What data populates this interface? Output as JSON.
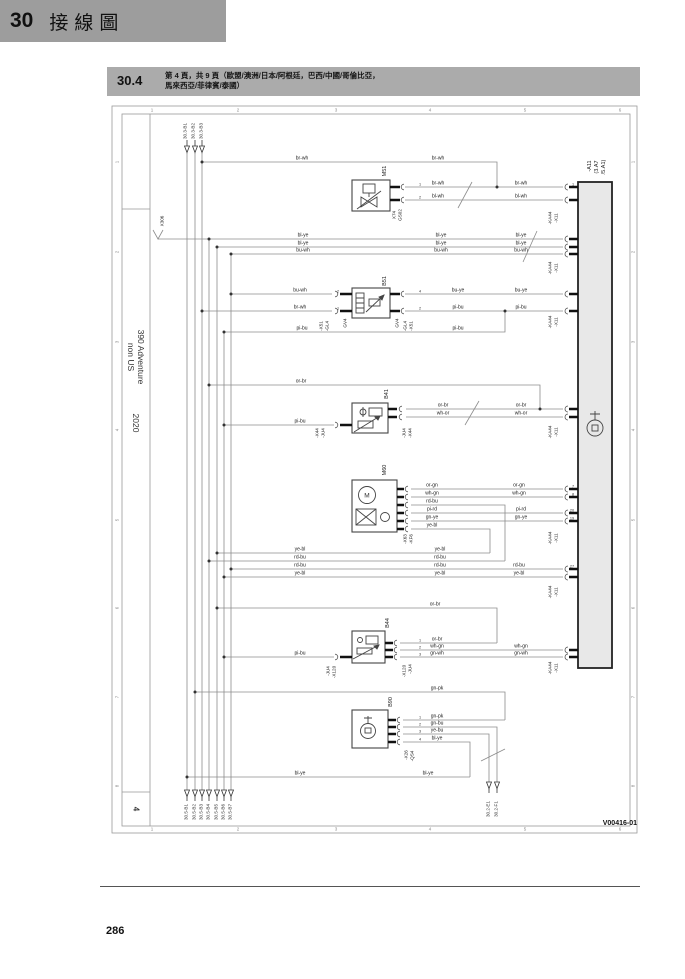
{
  "chapter": {
    "number": "30",
    "title": "接線圖"
  },
  "section": {
    "number": "30.4",
    "title_line1": "第 4 頁，共 9 頁（歐盟/澳洲/日本/阿根廷，巴西/中國/哥倫比亞，",
    "title_line2": "馬來西亞/菲律賓/泰國）"
  },
  "sidebar": {
    "model_line1": "390 Adventure",
    "model_line2": "non US",
    "year": "2020",
    "sheet": "4"
  },
  "footer": {
    "page_number": "286",
    "figure_id": "V00416-01"
  },
  "diagram": {
    "ecu_label": "-A11 (3.A7 /5.A1)",
    "ground_label": "X306",
    "component_ids": [
      "M51",
      "B51",
      "B41",
      "M60",
      "B44",
      "B90"
    ],
    "overlay_labels": [
      {
        "t": "br-wh",
        "c": "w",
        "x": 302,
        "y": 162
      },
      {
        "t": "br-wh",
        "c": "w",
        "x": 438,
        "y": 162
      },
      {
        "t": "br-wh",
        "c": "w",
        "x": 438,
        "y": 187
      },
      {
        "t": "bl-wh",
        "c": "w",
        "x": 438,
        "y": 200
      },
      {
        "t": "br-wh",
        "c": "w",
        "x": 521,
        "y": 187
      },
      {
        "t": "bl-wh",
        "c": "w",
        "x": 521,
        "y": 200
      },
      {
        "t": "bl-ye",
        "c": "w",
        "x": 303,
        "y": 239
      },
      {
        "t": "bl-ye",
        "c": "w",
        "x": 303,
        "y": 247
      },
      {
        "t": "bu-wh",
        "c": "w",
        "x": 303,
        "y": 254
      },
      {
        "t": "bl-ye",
        "c": "w",
        "x": 441,
        "y": 239
      },
      {
        "t": "bl-ye",
        "c": "w",
        "x": 441,
        "y": 247
      },
      {
        "t": "bu-wh",
        "c": "w",
        "x": 441,
        "y": 254
      },
      {
        "t": "bl-ye",
        "c": "w",
        "x": 521,
        "y": 239
      },
      {
        "t": "bl-ye",
        "c": "w",
        "x": 521,
        "y": 247
      },
      {
        "t": "bu-wh",
        "c": "w",
        "x": 521,
        "y": 254
      },
      {
        "t": "bu-wh",
        "c": "w",
        "x": 300,
        "y": 294
      },
      {
        "t": "br-wh",
        "c": "w",
        "x": 300,
        "y": 311
      },
      {
        "t": "pi-bu",
        "c": "w",
        "x": 302,
        "y": 332
      },
      {
        "t": "bu-ye",
        "c": "w",
        "x": 458,
        "y": 294
      },
      {
        "t": "pi-bu",
        "c": "w",
        "x": 458,
        "y": 311
      },
      {
        "t": "pi-bu",
        "c": "w",
        "x": 458,
        "y": 332
      },
      {
        "t": "bu-ye",
        "c": "w",
        "x": 521,
        "y": 294
      },
      {
        "t": "pi-bu",
        "c": "w",
        "x": 521,
        "y": 311
      },
      {
        "t": "or-br",
        "c": "w",
        "x": 301,
        "y": 385
      },
      {
        "t": "pi-bu",
        "c": "w",
        "x": 300,
        "y": 425
      },
      {
        "t": "or-br",
        "c": "w",
        "x": 443,
        "y": 409
      },
      {
        "t": "wh-or",
        "c": "w",
        "x": 443,
        "y": 417
      },
      {
        "t": "or-br",
        "c": "w",
        "x": 521,
        "y": 409
      },
      {
        "t": "wh-or",
        "c": "w",
        "x": 521,
        "y": 417
      },
      {
        "t": "or-gn",
        "c": "w",
        "x": 432,
        "y": 489
      },
      {
        "t": "wh-gn",
        "c": "w",
        "x": 432,
        "y": 497
      },
      {
        "t": "rd-bu",
        "c": "w",
        "x": 432,
        "y": 505
      },
      {
        "t": "pi-rd",
        "c": "w",
        "x": 432,
        "y": 513
      },
      {
        "t": "gn-ye",
        "c": "w",
        "x": 432,
        "y": 521
      },
      {
        "t": "ye-bl",
        "c": "w",
        "x": 432,
        "y": 529
      },
      {
        "t": "or-gn",
        "c": "w",
        "x": 519,
        "y": 489
      },
      {
        "t": "wh-gn",
        "c": "w",
        "x": 519,
        "y": 497
      },
      {
        "t": "pi-rd",
        "c": "w",
        "x": 521,
        "y": 513
      },
      {
        "t": "gn-ye",
        "c": "w",
        "x": 521,
        "y": 521
      },
      {
        "t": "ye-bl",
        "c": "w",
        "x": 300,
        "y": 553
      },
      {
        "t": "rd-bu",
        "c": "w",
        "x": 300,
        "y": 561
      },
      {
        "t": "rd-bu",
        "c": "w",
        "x": 300,
        "y": 569
      },
      {
        "t": "ye-bl",
        "c": "w",
        "x": 300,
        "y": 577
      },
      {
        "t": "ye-bl",
        "c": "w",
        "x": 440,
        "y": 553
      },
      {
        "t": "rd-bu",
        "c": "w",
        "x": 440,
        "y": 561
      },
      {
        "t": "rd-bu",
        "c": "w",
        "x": 440,
        "y": 569
      },
      {
        "t": "ye-bl",
        "c": "w",
        "x": 440,
        "y": 577
      },
      {
        "t": "rd-bu",
        "c": "w",
        "x": 519,
        "y": 569
      },
      {
        "t": "ye-bl",
        "c": "w",
        "x": 519,
        "y": 577
      },
      {
        "t": "or-br",
        "c": "w",
        "x": 435,
        "y": 608
      },
      {
        "t": "or-br",
        "c": "w",
        "x": 437,
        "y": 643
      },
      {
        "t": "wh-gn",
        "c": "w",
        "x": 437,
        "y": 650
      },
      {
        "t": "gn-wh",
        "c": "w",
        "x": 437,
        "y": 657
      },
      {
        "t": "wh-gn",
        "c": "w",
        "x": 521,
        "y": 650
      },
      {
        "t": "gn-wh",
        "c": "w",
        "x": 521,
        "y": 657
      },
      {
        "t": "pi-bu",
        "c": "w",
        "x": 300,
        "y": 657
      },
      {
        "t": "gn-pk",
        "c": "w",
        "x": 437,
        "y": 692
      },
      {
        "t": "gn-pk",
        "c": "w",
        "x": 437,
        "y": 720
      },
      {
        "t": "gn-bu",
        "c": "w",
        "x": 437,
        "y": 727
      },
      {
        "t": "ye-bu",
        "c": "w",
        "x": 437,
        "y": 734
      },
      {
        "t": "bl-ye",
        "c": "w",
        "x": 437,
        "y": 742
      },
      {
        "t": "bl-ye",
        "c": "w",
        "x": 300,
        "y": 777
      },
      {
        "t": "bl-ye",
        "c": "w",
        "x": 428,
        "y": 777
      },
      {
        "t": "X74",
        "c": "r",
        "x": 394,
        "y": 215
      },
      {
        "t": "GS02",
        "c": "r",
        "x": 400,
        "y": 215
      },
      {
        "t": "-X51",
        "c": "r",
        "x": 321,
        "y": 326
      },
      {
        "t": "-GL4",
        "c": "r",
        "x": 327,
        "y": 326
      },
      {
        "t": "GV4",
        "c": "r",
        "x": 345,
        "y": 323
      },
      {
        "t": "GV4",
        "c": "r",
        "x": 397,
        "y": 323
      },
      {
        "t": "-GL4",
        "c": "r",
        "x": 405,
        "y": 326
      },
      {
        "t": "-X51",
        "c": "r",
        "x": 411,
        "y": 326
      },
      {
        "t": "-X44",
        "c": "r",
        "x": 317,
        "y": 433
      },
      {
        "t": "-JU4",
        "c": "r",
        "x": 323,
        "y": 433
      },
      {
        "t": "-JU4",
        "c": "r",
        "x": 404,
        "y": 433
      },
      {
        "t": "-X44",
        "c": "r",
        "x": 410,
        "y": 433
      },
      {
        "t": "-X63",
        "c": "r",
        "x": 405,
        "y": 539
      },
      {
        "t": "-KF6",
        "c": "r",
        "x": 411,
        "y": 539
      },
      {
        "t": "-JU4",
        "c": "r",
        "x": 328,
        "y": 671
      },
      {
        "t": "-X120",
        "c": "r",
        "x": 334,
        "y": 672
      },
      {
        "t": "-X120",
        "c": "r",
        "x": 404,
        "y": 671
      },
      {
        "t": "-JU4",
        "c": "r",
        "x": 410,
        "y": 669
      },
      {
        "t": "-X26",
        "c": "r",
        "x": 406,
        "y": 755
      },
      {
        "t": "-QS4",
        "c": "r",
        "x": 412,
        "y": 756
      },
      {
        "t": "X306",
        "c": "r",
        "x": 162,
        "y": 221
      },
      {
        "t": "-KA44",
        "c": "r",
        "x": 550,
        "y": 218
      },
      {
        "t": "-X11",
        "c": "r",
        "x": 556,
        "y": 218
      },
      {
        "t": "-KA44",
        "c": "r",
        "x": 550,
        "y": 268
      },
      {
        "t": "-X11",
        "c": "r",
        "x": 556,
        "y": 268
      },
      {
        "t": "-KA44",
        "c": "r",
        "x": 550,
        "y": 322
      },
      {
        "t": "-X11",
        "c": "r",
        "x": 556,
        "y": 322
      },
      {
        "t": "-KA44",
        "c": "r",
        "x": 550,
        "y": 432
      },
      {
        "t": "-X11",
        "c": "r",
        "x": 556,
        "y": 432
      },
      {
        "t": "-KA44",
        "c": "r",
        "x": 550,
        "y": 538
      },
      {
        "t": "-X11",
        "c": "r",
        "x": 556,
        "y": 538
      },
      {
        "t": "-KA44",
        "c": "r",
        "x": 550,
        "y": 592
      },
      {
        "t": "-X11",
        "c": "r",
        "x": 556,
        "y": 592
      },
      {
        "t": "-KA44",
        "c": "r",
        "x": 550,
        "y": 668
      },
      {
        "t": "-X11",
        "c": "r",
        "x": 556,
        "y": 668
      },
      {
        "t": "M51",
        "c": "comp",
        "x": 385,
        "y": 171
      },
      {
        "t": "B51",
        "c": "comp",
        "x": 385,
        "y": 281
      },
      {
        "t": "B41",
        "c": "comp",
        "x": 387,
        "y": 394
      },
      {
        "t": "M60",
        "c": "comp",
        "x": 385,
        "y": 470
      },
      {
        "t": "B44",
        "c": "comp",
        "x": 388,
        "y": 623
      },
      {
        "t": "B90",
        "c": "comp",
        "x": 391,
        "y": 702
      },
      {
        "t": "-A11",
        "c": "comp",
        "x": 590,
        "y": 166
      },
      {
        "t": "(3.A7",
        "c": "comp",
        "x": 597,
        "y": 167
      },
      {
        "t": "/5.A1)",
        "c": "comp",
        "x": 604,
        "y": 167
      },
      {
        "t": "M",
        "c": "sym",
        "x": 367,
        "y": 496
      },
      {
        "t": "30.3-B1",
        "c": "ref",
        "x": 185,
        "y": 131
      },
      {
        "t": "30.3-B2",
        "c": "ref",
        "x": 193,
        "y": 131
      },
      {
        "t": "30.3-B3",
        "c": "ref",
        "x": 201,
        "y": 131
      },
      {
        "t": "30.5-B1",
        "c": "ref",
        "x": 186,
        "y": 812
      },
      {
        "t": "30.5-B2",
        "c": "ref",
        "x": 194,
        "y": 812
      },
      {
        "t": "30.5-B3",
        "c": "ref",
        "x": 201,
        "y": 812
      },
      {
        "t": "30.5-B4",
        "c": "ref",
        "x": 208,
        "y": 812
      },
      {
        "t": "30.5-B5",
        "c": "ref",
        "x": 216,
        "y": 812
      },
      {
        "t": "30.5-B6",
        "c": "ref",
        "x": 223,
        "y": 812
      },
      {
        "t": "30.5-B7",
        "c": "ref",
        "x": 230,
        "y": 812
      },
      {
        "t": "30.2-E1",
        "c": "ref",
        "x": 488,
        "y": 809
      },
      {
        "t": "30.2-F1",
        "c": "ref",
        "x": 496,
        "y": 809
      },
      {
        "t": "1",
        "c": "pin",
        "x": 573,
        "y": 187
      },
      {
        "t": "7",
        "c": "pin",
        "x": 573,
        "y": 489
      },
      {
        "t": "8",
        "c": "pin",
        "x": 573,
        "y": 497
      },
      {
        "t": "20",
        "c": "pin",
        "x": 572,
        "y": 513
      },
      {
        "t": "19",
        "c": "pin",
        "x": 572,
        "y": 521
      },
      {
        "t": "27",
        "c": "pin",
        "x": 572,
        "y": 569
      },
      {
        "t": "1",
        "c": "pin",
        "x": 420,
        "y": 720
      },
      {
        "t": "2",
        "c": "pin",
        "x": 420,
        "y": 727
      },
      {
        "t": "3",
        "c": "pin",
        "x": 420,
        "y": 734
      },
      {
        "t": "4",
        "c": "pin",
        "x": 420,
        "y": 742
      },
      {
        "t": "2",
        "c": "pin",
        "x": 338,
        "y": 294
      },
      {
        "t": "1",
        "c": "pin",
        "x": 338,
        "y": 311
      },
      {
        "t": "4",
        "c": "pin",
        "x": 420,
        "y": 294
      },
      {
        "t": "2",
        "c": "pin",
        "x": 420,
        "y": 311
      },
      {
        "t": "1",
        "c": "pin",
        "x": 420,
        "y": 187
      },
      {
        "t": "2",
        "c": "pin",
        "x": 420,
        "y": 200
      },
      {
        "t": "1",
        "c": "pin",
        "x": 420,
        "y": 643
      },
      {
        "t": "2",
        "c": "pin",
        "x": 420,
        "y": 650
      },
      {
        "t": "3",
        "c": "pin",
        "x": 420,
        "y": 657
      },
      {
        "t": "1",
        "c": "g",
        "x": 152,
        "y": 110
      },
      {
        "t": "2",
        "c": "g",
        "x": 238,
        "y": 110
      },
      {
        "t": "3",
        "c": "g",
        "x": 336,
        "y": 110
      },
      {
        "t": "4",
        "c": "g",
        "x": 430,
        "y": 110
      },
      {
        "t": "5",
        "c": "g",
        "x": 525,
        "y": 110
      },
      {
        "t": "6",
        "c": "g",
        "x": 620,
        "y": 110
      },
      {
        "t": "1",
        "c": "g",
        "x": 152,
        "y": 829
      },
      {
        "t": "2",
        "c": "g",
        "x": 238,
        "y": 829
      },
      {
        "t": "3",
        "c": "g",
        "x": 336,
        "y": 829
      },
      {
        "t": "4",
        "c": "g",
        "x": 430,
        "y": 829
      },
      {
        "t": "5",
        "c": "g",
        "x": 525,
        "y": 829
      },
      {
        "t": "6",
        "c": "g",
        "x": 620,
        "y": 829
      },
      {
        "t": "1",
        "c": "gr",
        "x": 117,
        "y": 162
      },
      {
        "t": "2",
        "c": "gr",
        "x": 117,
        "y": 252
      },
      {
        "t": "3",
        "c": "gr",
        "x": 117,
        "y": 342
      },
      {
        "t": "4",
        "c": "gr",
        "x": 117,
        "y": 430
      },
      {
        "t": "5",
        "c": "gr",
        "x": 117,
        "y": 520
      },
      {
        "t": "6",
        "c": "gr",
        "x": 117,
        "y": 608
      },
      {
        "t": "7",
        "c": "gr",
        "x": 117,
        "y": 697
      },
      {
        "t": "8",
        "c": "gr",
        "x": 117,
        "y": 786
      },
      {
        "t": "1",
        "c": "gr",
        "x": 633,
        "y": 162
      },
      {
        "t": "2",
        "c": "gr",
        "x": 633,
        "y": 252
      },
      {
        "t": "3",
        "c": "gr",
        "x": 633,
        "y": 342
      },
      {
        "t": "4",
        "c": "gr",
        "x": 633,
        "y": 430
      },
      {
        "t": "5",
        "c": "gr",
        "x": 633,
        "y": 520
      },
      {
        "t": "6",
        "c": "gr",
        "x": 633,
        "y": 608
      },
      {
        "t": "7",
        "c": "gr",
        "x": 633,
        "y": 697
      },
      {
        "t": "8",
        "c": "gr",
        "x": 633,
        "y": 786
      }
    ]
  }
}
